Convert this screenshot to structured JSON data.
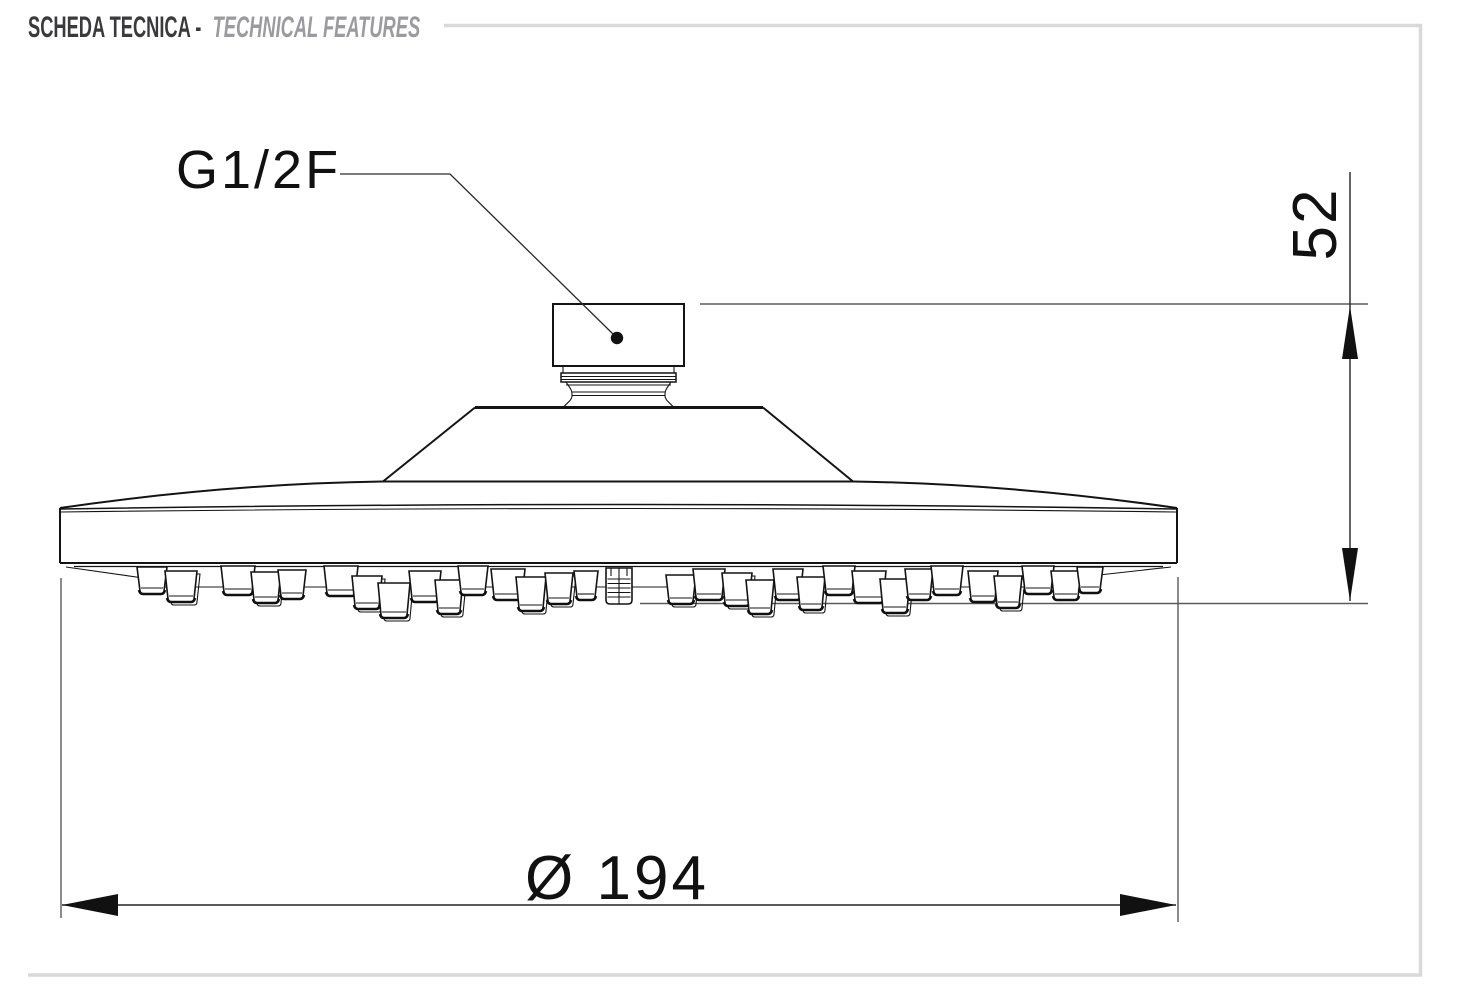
{
  "page": {
    "background": "#ffffff"
  },
  "header": {
    "title_primary": "SCHEDA TECNICA -",
    "title_secondary": "TECHNICAL FEATURES",
    "primary_color": "#3a3a3c",
    "secondary_color": "#9b9b9f",
    "rule_color": "#d9d9d9"
  },
  "drawing": {
    "labels": {
      "thread": "G1/2F",
      "height": "52",
      "diameter": "Ø 194"
    },
    "colors": {
      "outline": "#141414",
      "dimension": "#232323",
      "extension": "#5a5a5a",
      "arrow": "#111111"
    }
  }
}
